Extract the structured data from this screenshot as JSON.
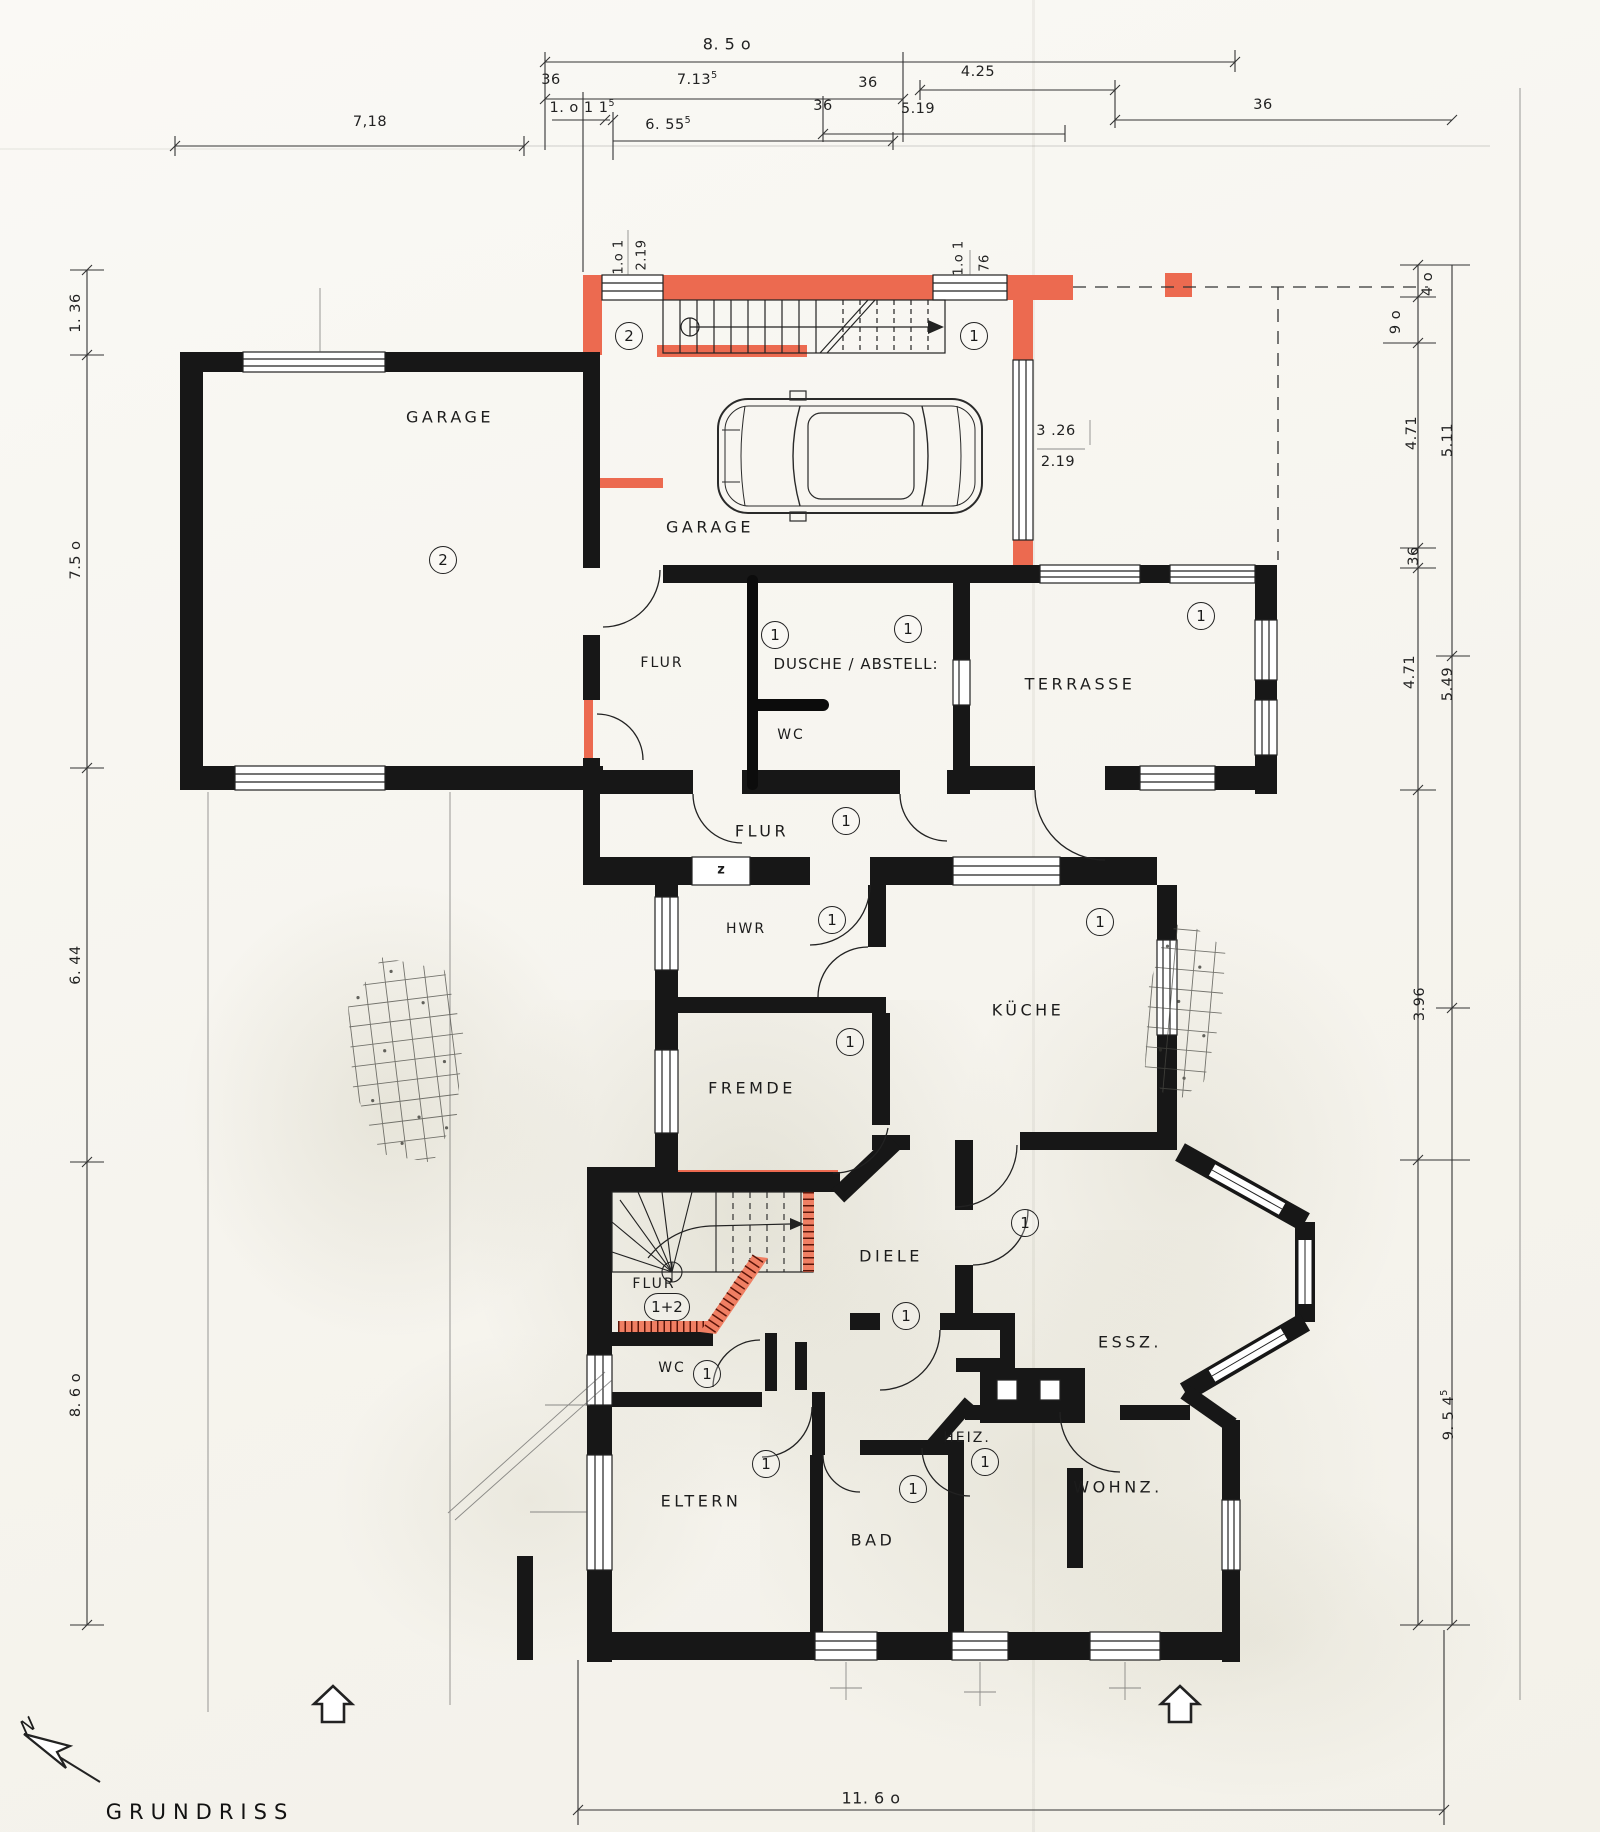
{
  "title": "GRUNDRISS",
  "compass_label": "N",
  "rooms": {
    "garage_left": "GARAGE",
    "garage_top": "GARAGE",
    "flur_upper": "FLUR",
    "dusche_abstell": "DUSCHE / ABSTELL:",
    "wc_upper": "WC",
    "terrasse": "TERRASSE",
    "flur_mid": "FLUR",
    "hwr": "HWR",
    "kueche": "KÜCHE",
    "fremde": "FREMDE",
    "diele": "DIELE",
    "essz": "ESSZ.",
    "flur_lower": "FLUR",
    "wc_lower": "WC",
    "heiz": "HEIZ.",
    "eltern": "ELTERN",
    "bad": "BAD",
    "wohnz": "WOHNZ."
  },
  "badges": {
    "one": "1",
    "two": "2",
    "one_two": "1+2"
  },
  "misc": {
    "z_label": "z"
  },
  "dimensions": {
    "top": {
      "d850": "8. 5 o",
      "d7135": "7.13",
      "d7135_sup": "5",
      "d425": "4.25",
      "d36_a": "36",
      "d36_b": "36",
      "d36_c": "36",
      "d36_d": "36",
      "d1o115": "1. o 1 1",
      "d1o115_sup": "5",
      "d6555": "6. 55",
      "d6555_sup": "5",
      "d519": "5.19",
      "d718": "7,18"
    },
    "left": {
      "d136": "1. 36",
      "d75o": "7.5 o",
      "d644": "6. 44",
      "d86o": "8. 6 o"
    },
    "right": {
      "d4o": "4 o",
      "d9o": "9 o",
      "d471_a": "4.71",
      "d511": "5.11",
      "d36": "36",
      "d471_b": "4.71",
      "d549": "5.49",
      "d396": "3.96",
      "d9545": "9. 5 4",
      "d9545_sup": "5"
    },
    "bottom": {
      "d116o": "11. 6 o"
    },
    "inner": {
      "d1o1_a": "1.o 1",
      "d219_a": "2.19",
      "d1o1_b": "1.o 1",
      "d76": "76",
      "d326": "3 .26",
      "d219_b": "2.19"
    }
  }
}
